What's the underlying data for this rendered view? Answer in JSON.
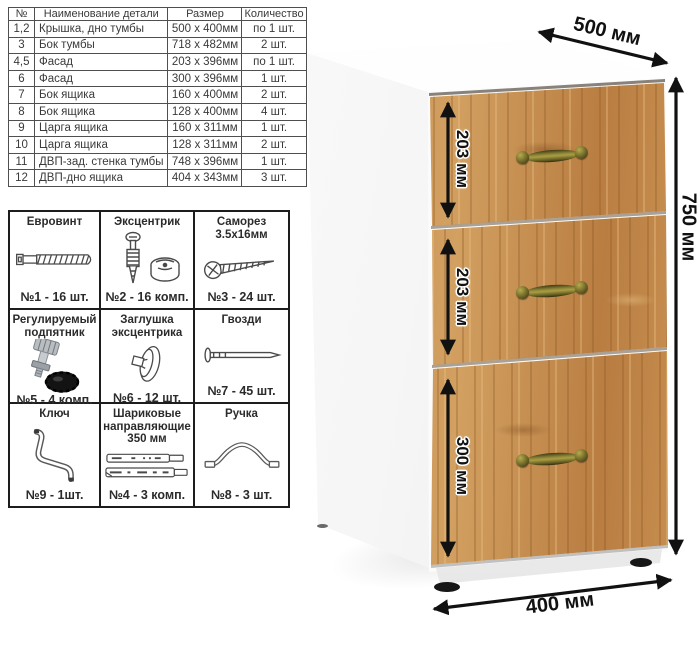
{
  "parts_table": {
    "headers": [
      "№",
      "Наименование детали",
      "Размер",
      "Количество"
    ],
    "rows": [
      [
        "1,2",
        "Крышка, дно тумбы",
        "500 х 400мм",
        "по 1 шт."
      ],
      [
        "3",
        "Бок тумбы",
        "718 х 482мм",
        "2 шт."
      ],
      [
        "4,5",
        "Фасад",
        "203 х 396мм",
        "по 1 шт."
      ],
      [
        "6",
        "Фасад",
        "300 х 396мм",
        "1 шт."
      ],
      [
        "7",
        "Бок ящика",
        "160 х 400мм",
        "2 шт."
      ],
      [
        "8",
        "Бок ящика",
        "128 х 400мм",
        "4 шт."
      ],
      [
        "9",
        "Царга ящика",
        "160 х 311мм",
        "1 шт."
      ],
      [
        "10",
        "Царга ящика",
        "128 х 311мм",
        "2 шт."
      ],
      [
        "11",
        "ДВП-зад. стенка тумбы",
        "748 х 396мм",
        "1 шт."
      ],
      [
        "12",
        "ДВП-дно ящика",
        "404 х 343мм",
        "3 шт."
      ]
    ]
  },
  "hardware": {
    "items": [
      {
        "title": "Евровинт",
        "count": "№1 - 16 шт.",
        "icon": "eurovint-screw-icon"
      },
      {
        "title": "Эксцентрик",
        "count": "№2 - 16 комп.",
        "icon": "eccentric-cam-icon"
      },
      {
        "title": "Саморез 3.5х16мм",
        "count": "№3 - 24 шт.",
        "icon": "self-tapping-screw-icon"
      },
      {
        "title": "Регулируемый подпятник",
        "count": "№5 - 4 комп.",
        "icon": "adjustable-foot-icon"
      },
      {
        "title": "Заглушка эксцентрика",
        "count": "№6 - 12 шт.",
        "icon": "cam-cover-icon"
      },
      {
        "title": "Гвозди",
        "count": "№7 - 45 шт.",
        "icon": "nail-icon"
      },
      {
        "title": "Ключ",
        "count": "№9 - 1шт.",
        "icon": "hex-key-icon"
      },
      {
        "title": "Шариковые направляющие 350 мм",
        "count": "№4 - 3 комп.",
        "icon": "ball-bearing-slides-icon"
      },
      {
        "title": "Ручка",
        "count": "№8 - 3 шт.",
        "icon": "drawer-handle-icon"
      }
    ]
  },
  "cabinet": {
    "dimensions": {
      "depth": "500 мм",
      "height": "750 мм",
      "width": "400 мм",
      "drawer1": "203 мм",
      "drawer2": "203 мм",
      "drawer3": "300 мм"
    },
    "colors": {
      "wood_base": "#c68e50",
      "wood_light": "#d8a766",
      "wood_dark": "#a06a33",
      "handle_brass": "#8f8838",
      "body_white": "#fbfbfb",
      "dimension_ink": "#111111"
    }
  }
}
